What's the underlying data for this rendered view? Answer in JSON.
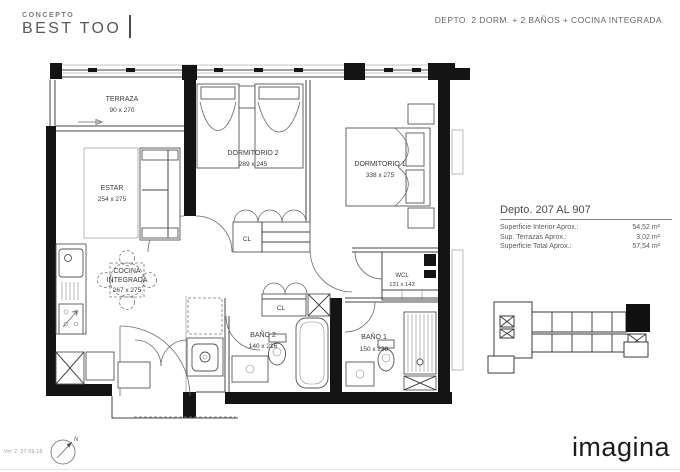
{
  "header": {
    "concept_label": "CONCEPTO",
    "concept_name": "BEST TOO",
    "unit_description": "DEPTO. 2 DORM. + 2 BAÑOS + COCINA INTEGRADA"
  },
  "info_panel": {
    "title": "Depto. 207 AL 907",
    "rows": [
      {
        "label": "Superficie Interior Aprox.:",
        "value": "54,52 m²"
      },
      {
        "label": "Sup. Terrazas Aprox.:",
        "value": "3,02 m²"
      },
      {
        "label": "Superficie Total Aprox.:",
        "value": "57,54 m²"
      }
    ]
  },
  "floor_plan": {
    "rooms": [
      {
        "name": "TERRAZA",
        "dims": "90 x 270"
      },
      {
        "name": "ESTAR",
        "dims": "254 x 275"
      },
      {
        "name": "DORMITORIO 2",
        "dims": "289 x 245"
      },
      {
        "name": "DORMITORIO 1",
        "dims": "338 x 275"
      },
      {
        "name_lines": [
          "COCINA",
          "INTEGRADA"
        ],
        "dims": "267 x 275"
      },
      {
        "name": "WCL",
        "dims": "131 x 143"
      },
      {
        "name": "BAÑO 2",
        "dims": "140 x 216"
      },
      {
        "name": "BAÑO 1",
        "dims": "150 x 230"
      }
    ],
    "closet_label": "CL",
    "compass_label": "N"
  },
  "footer": {
    "version": "Ver 2: 27.09.18",
    "brand": "imagina"
  },
  "colors": {
    "wall": "#141414",
    "line": "#444444",
    "text": "#555555",
    "brand_text": "#1d1d1b"
  }
}
